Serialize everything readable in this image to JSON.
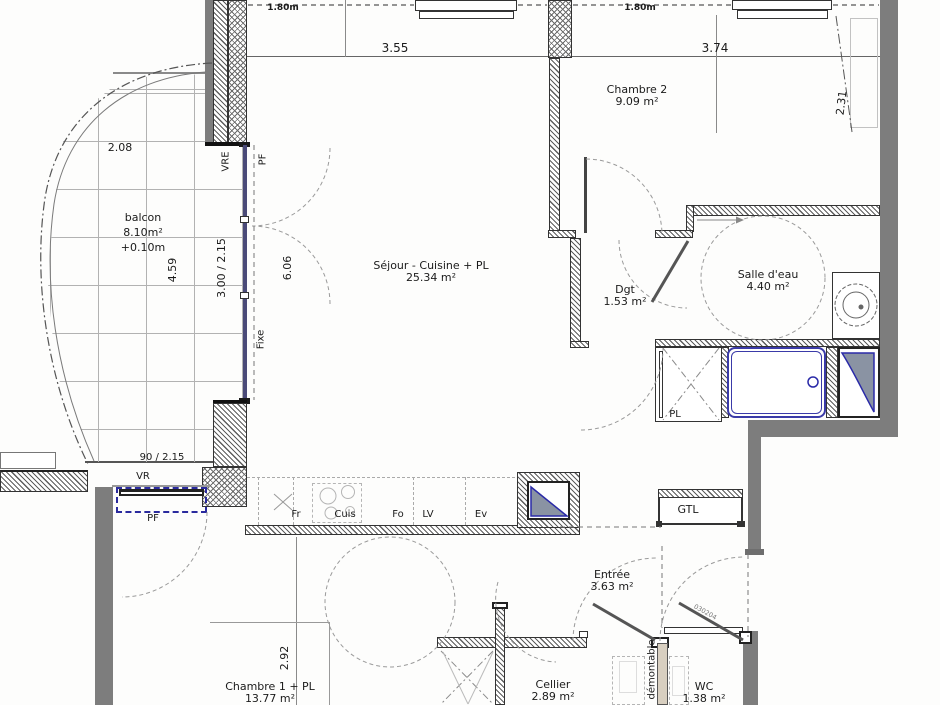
{
  "rooms": {
    "balcon": {
      "name": "balcon",
      "area": "8.10m²",
      "level": "+0.10m"
    },
    "sejour": {
      "name": "Séjour - Cuisine + PL",
      "area": "25.34 m²"
    },
    "chambre2": {
      "name": "Chambre 2",
      "area": "9.09 m²"
    },
    "dgt": {
      "name": "Dgt",
      "area": "1.53 m²"
    },
    "salle_deau": {
      "name": "Salle d'eau",
      "area": "4.40 m²"
    },
    "entree": {
      "name": "Entrée",
      "area": "3.63 m²"
    },
    "cellier": {
      "name": "Cellier",
      "area": "2.89 m²"
    },
    "wc": {
      "name": "WC",
      "area": "1.38 m²"
    },
    "chambre1": {
      "name": "Chambre 1 + PL",
      "area": "13.77 m²"
    }
  },
  "dimensions": {
    "sill_height_left": "1.80m",
    "sill_height_right": "1.80m",
    "sejour_width": "3.55",
    "chambre2_width": "3.74",
    "chambre2_depth": "2.31",
    "balcon_width": "2.08",
    "balcon_depth": "4.59",
    "bay_size": "3.00 / 2.15",
    "glazing_height": "6.06",
    "side_door_size": "90 / 2.15",
    "chambre1_width": "2.92"
  },
  "marks": {
    "vre": "VRE",
    "pf_top": "PF",
    "fixe": "Fixe",
    "vr": "VR",
    "pf_bottom": "PF",
    "gtl": "GTL",
    "pl": "PL",
    "demontable": "démontable",
    "door_code": "030204",
    "fr": "Fr",
    "cuis": "Cuis",
    "fo": "Fo",
    "lv": "LV",
    "ev": "Ev"
  },
  "colors": {
    "wall_gray": "#7d7d7d",
    "window_blue": "#4a4a78",
    "fitting_blue": "#2a2aa8",
    "partition_tan": "#d8cfc0",
    "hatch_line": "#5d5d5d"
  }
}
